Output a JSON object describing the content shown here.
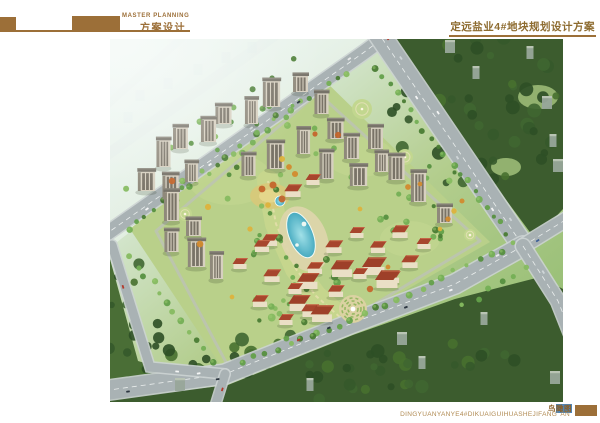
{
  "header": {
    "master_label": "MASTER PLANNING",
    "scheme_label": "方案设计",
    "project_title": "定远盐业4#地块规划设计方案",
    "accent_color": "#9c6f38"
  },
  "footer": {
    "view_label_plain": "鸟",
    "view_label_highlight": "瞰图",
    "pinyin_title": "DINGYUANYANYE4#DIKUAIGUIHUASHEJIFANG' AN",
    "highlight_color": "#4f86b8"
  },
  "scene": {
    "viewbox": [
      0,
      0,
      453,
      363
    ],
    "palette": {
      "road": "#a9b2b4",
      "road_edge": "#ccd3d3",
      "marking": "#f2f5f4",
      "site": "#b9d08a",
      "lawn": "#c6d892",
      "forest_dark": "#3c5c2e",
      "forest_mid": "#4a6e36",
      "greens": [
        "#4a7c34",
        "#569040",
        "#63a04a",
        "#74af55",
        "#86bb60"
      ],
      "dark_greens": [
        "#2e4f26",
        "#35592b",
        "#3f6631",
        "#47702f"
      ],
      "accents": [
        "#d28a2e",
        "#ddb23c",
        "#c4652c"
      ],
      "tower_front": "#d7d0c0",
      "tower_side": "#8f897b",
      "tower_roof": "#767268",
      "tower_window": "#5a544a",
      "villa_wall": "#eadfc6",
      "villa_roof": "#a7452d",
      "commercial_roof": "#9e4029",
      "deck": "#dcd5ab",
      "pool_deep": "#3fa9c2",
      "pool_light": "#9fe2ec",
      "shadow": "rgba(45,60,35,0.4)",
      "distant": "#98a79a",
      "haze_bld": "#bcd2cf",
      "car_colors": [
        "#f5f6f6",
        "#2c3640",
        "#cfd6d8",
        "#b33a2c",
        "#3d5f96",
        "#e8e9e9"
      ]
    },
    "site_poly": [
      [
        20,
        190
      ],
      [
        209,
        36
      ],
      [
        380,
        203
      ],
      [
        240,
        283
      ],
      [
        115,
        333
      ]
    ],
    "ring_road": [
      [
        46,
        192
      ],
      [
        208,
        54
      ],
      [
        370,
        202
      ],
      [
        240,
        280
      ],
      [
        118,
        327
      ]
    ],
    "lawns": [
      {
        "cx": 120,
        "cy": 140,
        "rx": 42,
        "ry": 26
      },
      {
        "cx": 250,
        "cy": 118,
        "rx": 34,
        "ry": 20
      },
      {
        "cx": 300,
        "cy": 200,
        "rx": 30,
        "ry": 18
      }
    ],
    "forests": [
      {
        "id": "top-right",
        "poly": [
          [
            277,
            0
          ],
          [
            453,
            0
          ],
          [
            453,
            170
          ],
          [
            425,
            200
          ],
          [
            277,
            0
          ]
        ],
        "fill": "dark"
      },
      {
        "id": "bottom",
        "poly": [
          [
            453,
            250
          ],
          [
            430,
            238
          ],
          [
            345,
            260
          ],
          [
            243,
            296
          ],
          [
            118,
            346
          ],
          [
            0,
            360
          ],
          [
            0,
            363
          ],
          [
            453,
            363
          ]
        ],
        "fill": "dark"
      },
      {
        "id": "left-strip",
        "poly": [
          [
            0,
            220
          ],
          [
            28,
            322
          ],
          [
            95,
            342
          ],
          [
            0,
            355
          ]
        ],
        "fill": "mid"
      }
    ],
    "clearings": [
      {
        "cx": 428,
        "cy": 58,
        "rx": 20,
        "ry": 12
      },
      {
        "cx": 396,
        "cy": 128,
        "rx": 15,
        "ry": 9
      }
    ],
    "roads": [
      {
        "id": "haze-road-1",
        "pts": [
          [
            -20,
            128
          ],
          [
            185,
            -18
          ]
        ],
        "w": 11,
        "faint": true
      },
      {
        "id": "haze-road-2",
        "pts": [
          [
            -25,
            86
          ],
          [
            95,
            -22
          ]
        ],
        "w": 8,
        "faint": true
      },
      {
        "id": "nw-road",
        "pts": [
          [
            -28,
            212
          ],
          [
            253,
            14
          ],
          [
            272,
            0
          ]
        ],
        "w": 14,
        "dash": true,
        "cars": 6
      },
      {
        "id": "ne-road",
        "pts": [
          [
            267,
            -8
          ],
          [
            413,
            207
          ]
        ],
        "w": 21,
        "dash": true,
        "cars": 8
      },
      {
        "id": "se-road",
        "pts": [
          [
            413,
            207
          ],
          [
            345,
            245
          ],
          [
            240,
            285
          ],
          [
            115,
            335
          ],
          [
            -8,
            352
          ]
        ],
        "w": 19,
        "dash": true,
        "cars": 8
      },
      {
        "id": "sw-road",
        "pts": [
          [
            2,
            206
          ],
          [
            40,
            328
          ],
          [
            115,
            335
          ]
        ],
        "w": 9,
        "cars": 2
      },
      {
        "id": "east-exit-upper",
        "pts": [
          [
            413,
            207
          ],
          [
            470,
            172
          ]
        ],
        "w": 14,
        "dash": true,
        "cars": 2
      },
      {
        "id": "east-exit-lower",
        "pts": [
          [
            413,
            207
          ],
          [
            448,
            262
          ],
          [
            475,
            330
          ]
        ],
        "w": 14,
        "dash": true,
        "cars": 2
      },
      {
        "id": "south-exit",
        "pts": [
          [
            115,
            335
          ],
          [
            106,
            364
          ]
        ],
        "w": 9,
        "cars": 1
      }
    ],
    "towers": [
      [
        192,
        53
      ],
      [
        213,
        75
      ],
      [
        163,
        68
      ],
      [
        143,
        85
      ],
      [
        115,
        85
      ],
      [
        100,
        103
      ],
      [
        72,
        110
      ],
      [
        55,
        128
      ],
      [
        38,
        152
      ],
      [
        83,
        143
      ],
      [
        62,
        160
      ],
      [
        63,
        182
      ],
      [
        85,
        197
      ],
      [
        140,
        137
      ],
      [
        167,
        130
      ],
      [
        195,
        115
      ],
      [
        227,
        100
      ],
      [
        243,
        120
      ],
      [
        267,
        110
      ],
      [
        218,
        140
      ],
      [
        250,
        147
      ],
      [
        273,
        133
      ],
      [
        288,
        141
      ],
      [
        310,
        163
      ],
      [
        336,
        184
      ],
      [
        63,
        213
      ],
      [
        88,
        228
      ],
      [
        108,
        240
      ]
    ],
    "villas": [
      [
        130,
        230
      ],
      [
        152,
        213
      ],
      [
        162,
        243
      ],
      [
        185,
        255
      ],
      [
        205,
        235
      ],
      [
        224,
        214
      ],
      [
        247,
        199
      ],
      [
        268,
        214
      ],
      [
        290,
        199
      ],
      [
        250,
        240
      ],
      [
        226,
        258
      ],
      [
        200,
        278
      ],
      [
        176,
        286
      ],
      [
        150,
        268
      ],
      [
        300,
        229
      ],
      [
        314,
        210
      ],
      [
        282,
        244
      ],
      [
        183,
        158
      ],
      [
        203,
        146
      ],
      [
        160,
        207
      ]
    ],
    "commercial": [
      [
        198,
        250
      ],
      [
        232,
        238
      ],
      [
        264,
        236
      ],
      [
        189,
        272
      ],
      [
        212,
        283
      ],
      [
        277,
        249
      ]
    ],
    "plaza": {
      "cx": 243,
      "cy": 270,
      "r": 14
    },
    "parks": [
      {
        "cx": 252,
        "cy": 70,
        "r": 10
      },
      {
        "cx": 295,
        "cy": 118,
        "r": 8
      },
      {
        "cx": 360,
        "cy": 196,
        "r": 6
      },
      {
        "cx": 75,
        "cy": 175,
        "r": 7
      }
    ],
    "nw_garden": {
      "cx": 160,
      "cy": 157,
      "rx": 20,
      "ry": 13
    },
    "garden_axis": [
      [
        158,
        142
      ],
      [
        166,
        185
      ],
      [
        186,
        230
      ],
      [
        206,
        257
      ],
      [
        232,
        280
      ]
    ],
    "pool": {
      "cx": 191,
      "cy": 196,
      "rx": 12,
      "ry": 24,
      "rot": -22
    },
    "deck": {
      "cx": 194,
      "cy": 200,
      "rx": 23,
      "ry": 34,
      "rot": -22
    },
    "pond": {
      "cx": 170,
      "cy": 162,
      "r": 5
    },
    "islands": [
      [
        194,
        185,
        2.4
      ],
      [
        187,
        206,
        1.8
      ]
    ],
    "tree_lines": [
      {
        "pts": [
          [
            14,
            192
          ],
          [
            240,
            30
          ]
        ],
        "n": 26,
        "r": [
          2,
          3.5
        ]
      },
      {
        "pts": [
          [
            262,
            26
          ],
          [
            402,
            198
          ]
        ],
        "n": 20,
        "r": [
          2,
          3.5
        ]
      },
      {
        "pts": [
          [
            408,
            204
          ],
          [
            248,
            278
          ]
        ],
        "n": 14,
        "r": [
          2,
          3.5
        ]
      },
      {
        "pts": [
          [
            248,
            278
          ],
          [
            124,
            326
          ]
        ],
        "n": 10,
        "r": [
          2,
          3.5
        ]
      },
      {
        "pts": [
          [
            16,
            212
          ],
          [
            106,
            326
          ]
        ],
        "n": 12,
        "r": [
          2,
          3.5
        ]
      },
      {
        "pts": [
          [
            -14,
            176
          ],
          [
            196,
            12
          ]
        ],
        "n": 10,
        "r": [
          2,
          3
        ]
      },
      {
        "pts": [
          [
            424,
            224
          ],
          [
            348,
            272
          ]
        ],
        "n": 6,
        "r": [
          2,
          3
        ]
      }
    ],
    "tree_blobs": [
      {
        "cx": 150,
        "cy": 120,
        "rx": 95,
        "ry": 72,
        "n": 30,
        "r": [
          1.8,
          3.4
        ]
      },
      {
        "cx": 185,
        "cy": 240,
        "rx": 58,
        "ry": 62,
        "n": 26,
        "r": [
          2,
          4
        ]
      },
      {
        "cx": 320,
        "cy": 168,
        "rx": 52,
        "ry": 42,
        "n": 16,
        "r": [
          2,
          3.5
        ]
      },
      {
        "cx": 368,
        "cy": 72,
        "rx": 88,
        "ry": 78,
        "n": 46,
        "r": [
          3.5,
          7
        ],
        "dark": true
      },
      {
        "cx": 215,
        "cy": 330,
        "rx": 205,
        "ry": 34,
        "n": 54,
        "r": [
          3.5,
          7
        ],
        "dark": true
      },
      {
        "cx": 28,
        "cy": 285,
        "rx": 34,
        "ry": 62,
        "n": 16,
        "r": [
          3,
          6
        ],
        "dark": true
      }
    ],
    "accent_trees": [
      [
        152,
        150
      ],
      [
        163,
        146
      ],
      [
        158,
        166
      ],
      [
        172,
        160
      ],
      [
        62,
        142
      ],
      [
        98,
        168
      ],
      [
        228,
        96
      ],
      [
        298,
        148
      ],
      [
        122,
        258
      ],
      [
        278,
        228
      ],
      [
        172,
        120
      ],
      [
        179,
        128
      ],
      [
        185,
        135
      ],
      [
        330,
        190
      ],
      [
        90,
        205
      ],
      [
        250,
        170
      ],
      [
        140,
        190
      ],
      [
        310,
        145
      ],
      [
        205,
        95
      ],
      [
        260,
        250
      ],
      [
        344,
        172
      ],
      [
        352,
        162
      ],
      [
        338,
        180
      ]
    ],
    "distant_buildings": [
      [
        340,
        14
      ],
      [
        366,
        40
      ],
      [
        437,
        70
      ],
      [
        443,
        108
      ],
      [
        448,
        133
      ],
      [
        420,
        20
      ],
      [
        292,
        306
      ],
      [
        312,
        330
      ],
      [
        70,
        352
      ],
      [
        374,
        286
      ],
      [
        445,
        345
      ],
      [
        200,
        352
      ]
    ],
    "haze_buildings": [
      [
        30,
        56
      ],
      [
        58,
        44
      ],
      [
        88,
        30
      ],
      [
        18,
        78
      ],
      [
        116,
        18
      ],
      [
        142,
        8
      ]
    ],
    "fog_poly": [
      [
        -2,
        210
      ],
      [
        150,
        92
      ],
      [
        258,
        4
      ],
      [
        258,
        -2
      ],
      [
        -2,
        -2
      ]
    ]
  }
}
